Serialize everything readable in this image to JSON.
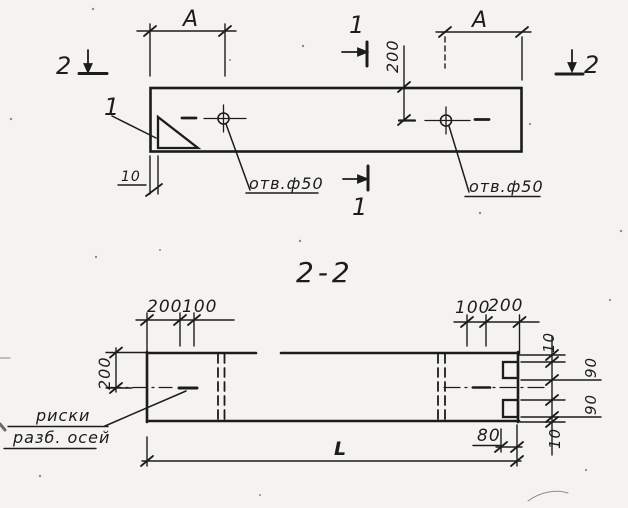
{
  "palette": {
    "ink": "#1c1c1c",
    "paper": "#f4f3ef"
  },
  "plan_view": {
    "dim_a_left": "A",
    "dim_a_right": "A",
    "dim_hole_offset": "200",
    "dim_end_wall": "10",
    "hole_note_left": "отв.ф50",
    "hole_note_right": "отв.ф50",
    "detail_mark": "1",
    "section1_mark_top": "1",
    "section1_mark_bottom": "1",
    "section2_mark_left": "2",
    "section2_mark_right": "2"
  },
  "section_view": {
    "title": "2-2",
    "dims_top_left": [
      "200",
      "100"
    ],
    "dims_top_right": [
      "100",
      "200"
    ],
    "dim_height": "200",
    "dims_right_chain": [
      "10",
      "90",
      "90",
      "10"
    ],
    "dim_notch": "80",
    "dim_length": "L",
    "axes_note": [
      "риски",
      "разб. осей"
    ]
  }
}
